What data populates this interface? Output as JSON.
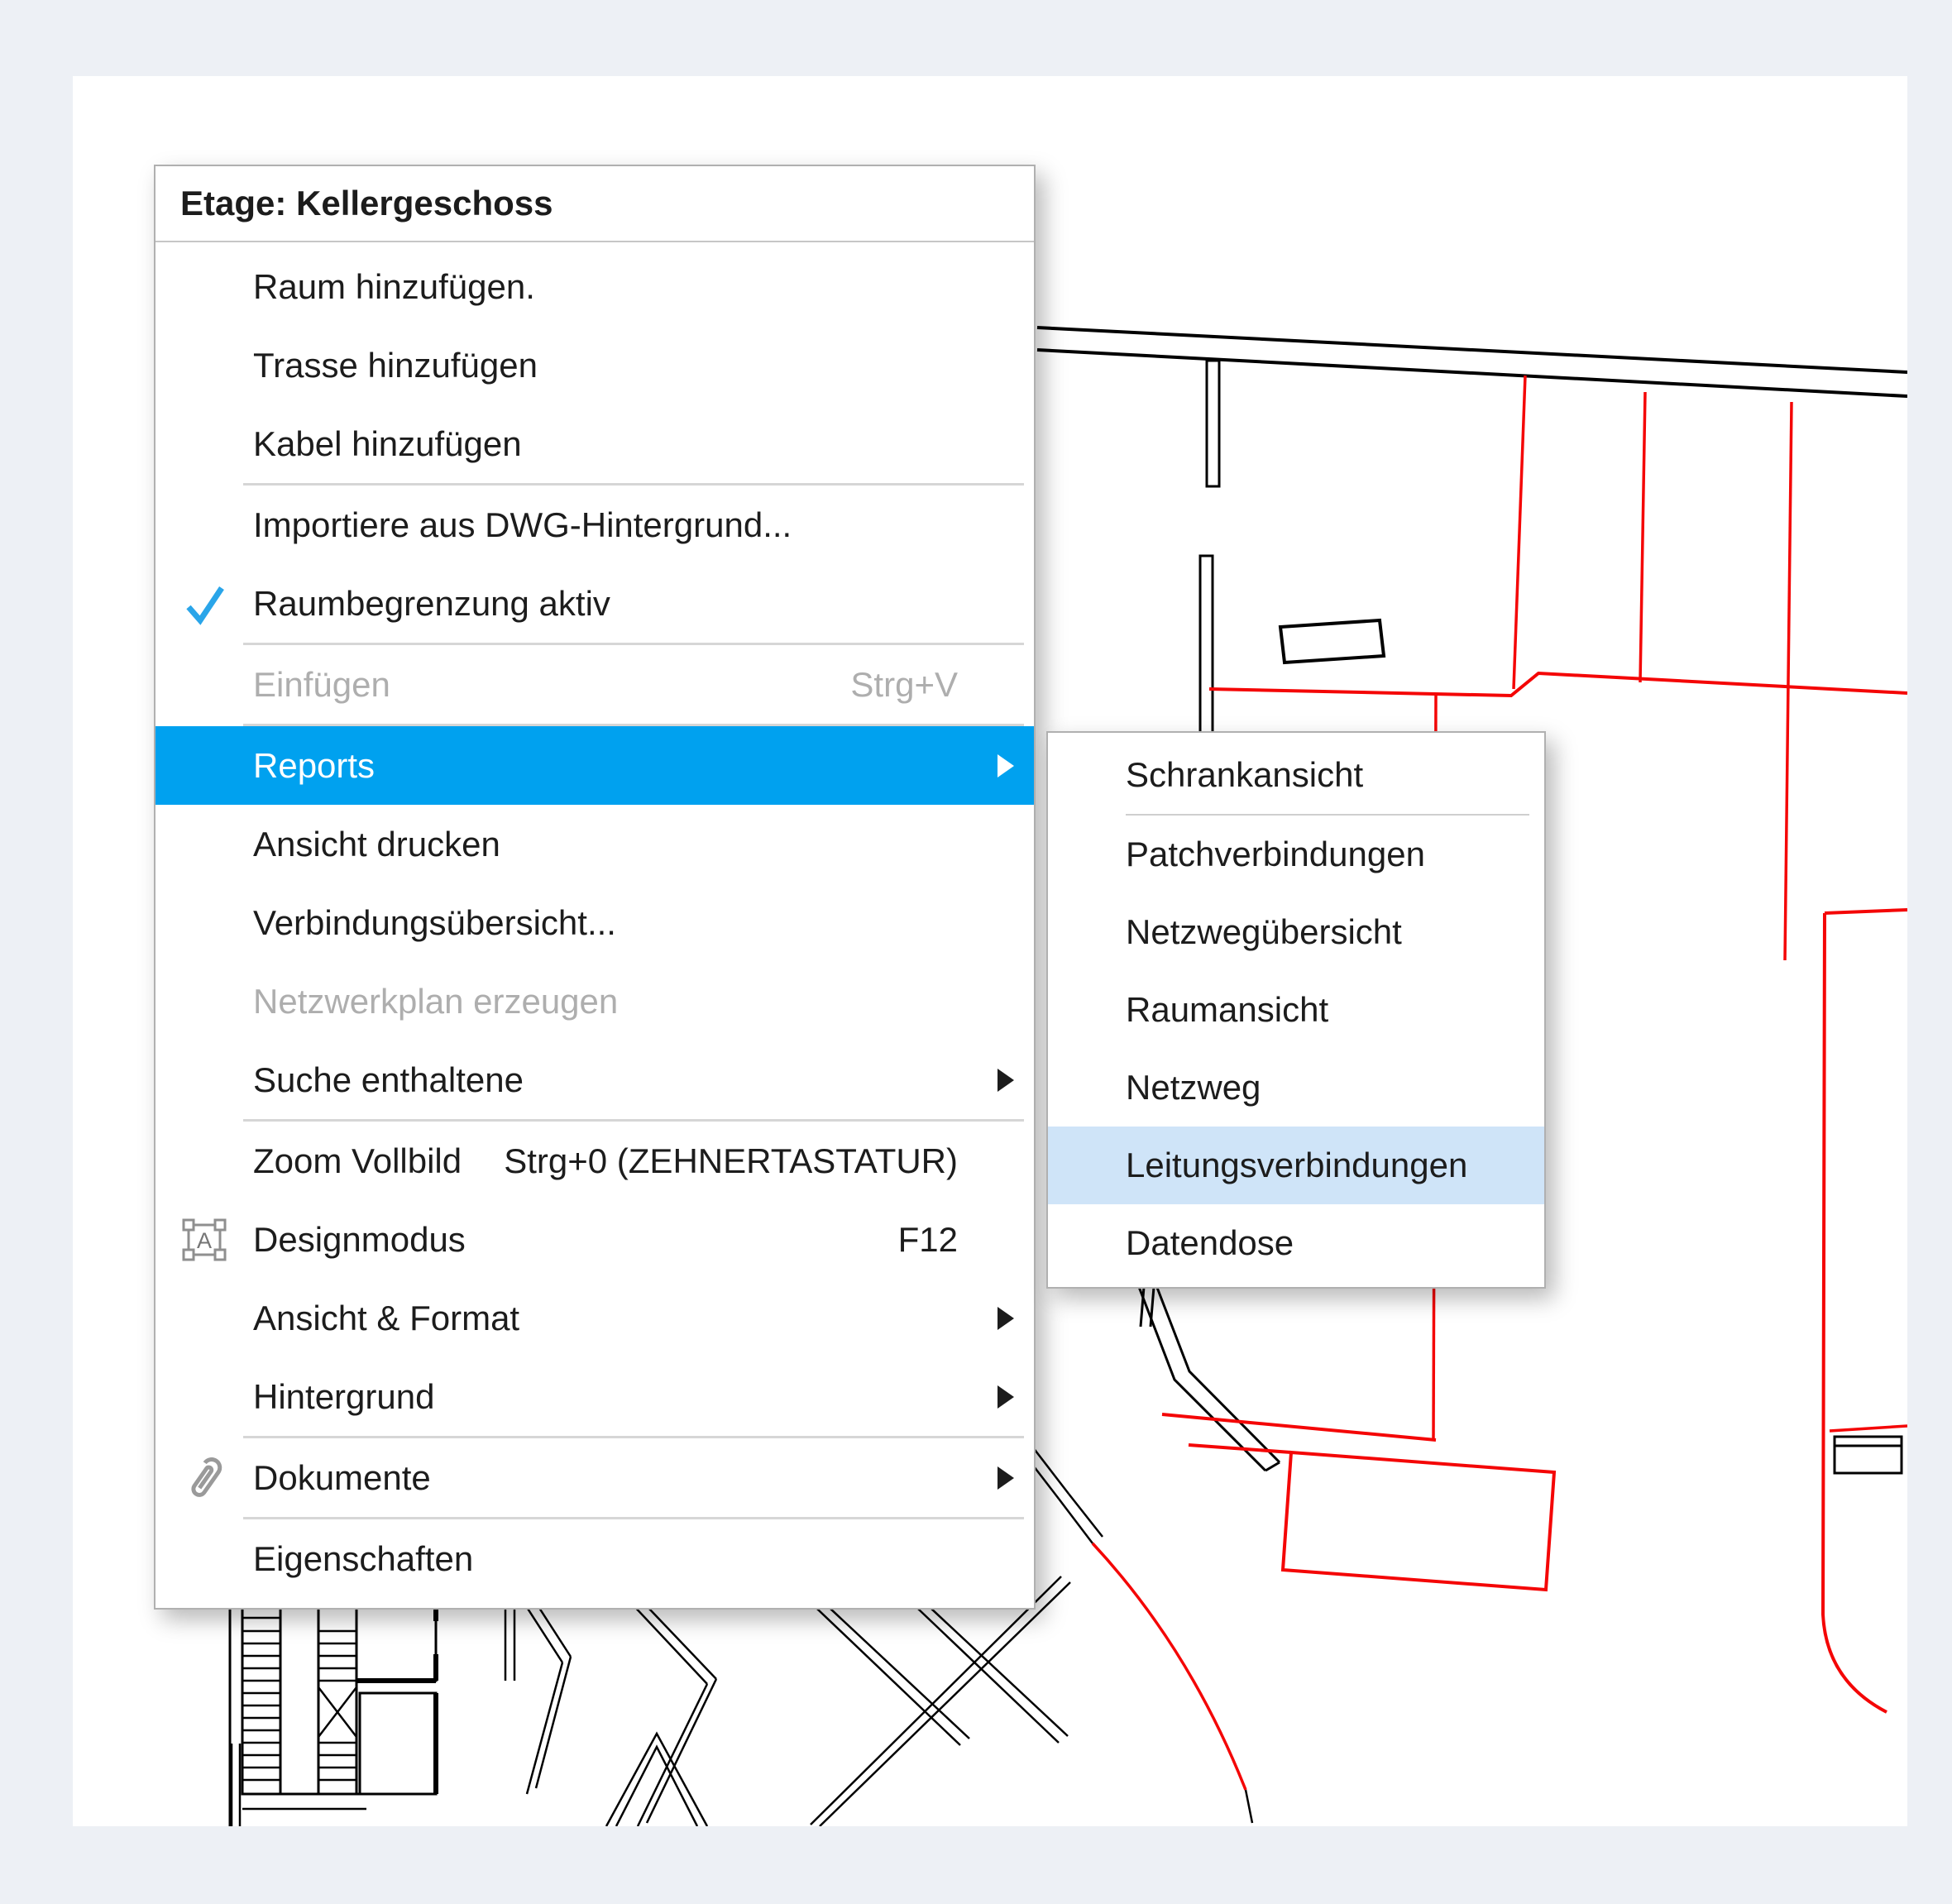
{
  "colors": {
    "page_bg": "#edf0f5",
    "canvas_bg": "#ffffff",
    "menu_bg": "#ffffff",
    "menu_border": "#b0b0b0",
    "text": "#1c1c1c",
    "disabled_text": "#aeaeae",
    "separator": "#d6d6d6",
    "selection_bg": "#00a1ef",
    "selection_text": "#ffffff",
    "submenu_selection_bg": "#cfe4f8",
    "checkmark_blue": "#2aa5e9",
    "plan_line_black": "#000000",
    "plan_line_red": "#f40606"
  },
  "icons": {
    "design_mode_glyph": "A"
  },
  "context_menu": {
    "header": "Etage: Kellergeschoss",
    "items": [
      {
        "label": "Raum hinzufügen."
      },
      {
        "label": "Trasse hinzufügen"
      },
      {
        "label": "Kabel hinzufügen"
      },
      {
        "label": "Importiere aus DWG-Hintergrund..."
      },
      {
        "label": "Raumbegrenzung aktiv",
        "checked": true
      },
      {
        "label": "Einfügen",
        "shortcut": "Strg+V",
        "disabled": true
      },
      {
        "label": "Reports",
        "selected": true,
        "has_submenu": true
      },
      {
        "label": "Ansicht drucken"
      },
      {
        "label": "Verbindungsübersicht..."
      },
      {
        "label": "Netzwerkplan erzeugen",
        "disabled": true
      },
      {
        "label": "Suche enthaltene",
        "has_submenu": true
      },
      {
        "label": "Zoom Vollbild",
        "shortcut": "Strg+0 (ZEHNERTASTATUR)"
      },
      {
        "label": "Designmodus",
        "shortcut": "F12",
        "icon": "design-mode-icon"
      },
      {
        "label": "Ansicht & Format",
        "has_submenu": true
      },
      {
        "label": "Hintergrund",
        "has_submenu": true
      },
      {
        "label": "Dokumente",
        "has_submenu": true,
        "icon": "paperclip-icon"
      },
      {
        "label": "Eigenschaften"
      }
    ]
  },
  "reports_submenu": {
    "items": [
      {
        "label": "Schrankansicht"
      },
      {
        "label": "Patchverbindungen"
      },
      {
        "label": "Netzwegübersicht"
      },
      {
        "label": "Raumansicht"
      },
      {
        "label": "Netzweg"
      },
      {
        "label": "Leitungsverbindungen",
        "selected": true
      },
      {
        "label": "Datendose"
      }
    ]
  }
}
